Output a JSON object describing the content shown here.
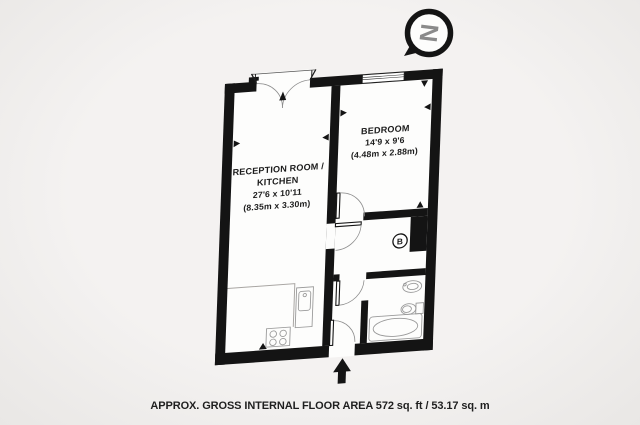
{
  "plan": {
    "reception": {
      "line1": "RECEPTION ROOM /",
      "line2": "KITCHEN",
      "dims_ft": "27'6 x 10'11",
      "dims_m": "(8.35m x 3.30m)"
    },
    "bedroom": {
      "name": "BEDROOM",
      "dims_ft": "14'9 x 9'6",
      "dims_m": "(4.48m x 2.88m)"
    },
    "boiler_label": "B",
    "compass_letter": "N"
  },
  "caption": "APPROX. GROSS INTERNAL FLOOR AREA 572 sq. ft / 53.17 sq. m",
  "colors": {
    "wall": "#141414",
    "floor": "#fdfdfc",
    "background": "#f2f0ee",
    "fixture": "#9a9a9a",
    "compass_letter": "#8a8a8a",
    "text": "#1c1c1c"
  }
}
